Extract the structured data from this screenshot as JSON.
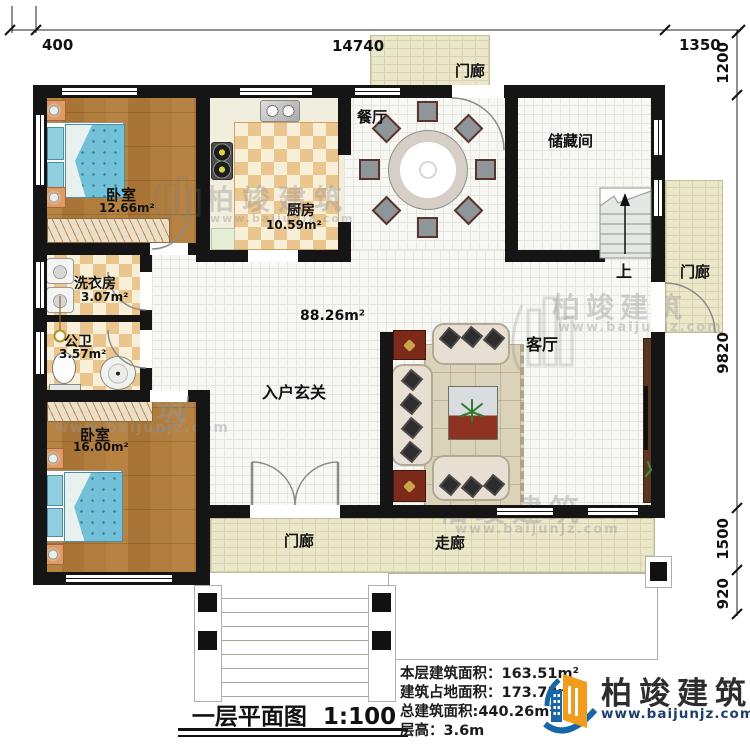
{
  "dimensions": {
    "top": [
      "400",
      "14740",
      "1350"
    ],
    "right": [
      "1200",
      "9820",
      "1500",
      "920"
    ]
  },
  "rooms": {
    "bedroom1": {
      "name": "卧室",
      "area": "12.66m²"
    },
    "kitchen": {
      "name": "厨房",
      "area": "10.59m²"
    },
    "dining": {
      "name": "餐厅"
    },
    "storage": {
      "name": "储藏间"
    },
    "porch_top": {
      "name": "门廊"
    },
    "porch_right": {
      "name": "门廊"
    },
    "porch_bottom": {
      "name": "门廊"
    },
    "corridor": {
      "name": "走廊"
    },
    "laundry": {
      "name": "洗衣房",
      "area": "3.07m²"
    },
    "bathroom": {
      "name": "公卫",
      "area": "3.57m²"
    },
    "bedroom2": {
      "name": "卧室",
      "area": "16.00m²"
    },
    "foyer": {
      "name": "入户玄关"
    },
    "living": {
      "name": "客厅"
    },
    "hall_area": "88.26m²",
    "stairs_label": "上"
  },
  "plan_title": {
    "name": "一层平面图",
    "scale": "1:100"
  },
  "info": {
    "floor_area_label": "本层建筑面积：",
    "floor_area_value": "163.51m²",
    "footprint_label": "建筑占地面积：",
    "footprint_value": "173.73m²",
    "total_area_label": "总建筑面积:",
    "total_area_value": "440.26m²",
    "height_label": "层高：",
    "height_value": "3.6m"
  },
  "brand": {
    "name": "柏竣建筑",
    "url": "www.baijunjz.com"
  },
  "watermark": {
    "name": "柏竣建筑",
    "url": "www.baijunjz.com"
  },
  "colors": {
    "wall": "#151515",
    "logo_blue": "#1766a6",
    "logo_orange": "#f29c1e",
    "url_navy": "#1d3e6e"
  }
}
